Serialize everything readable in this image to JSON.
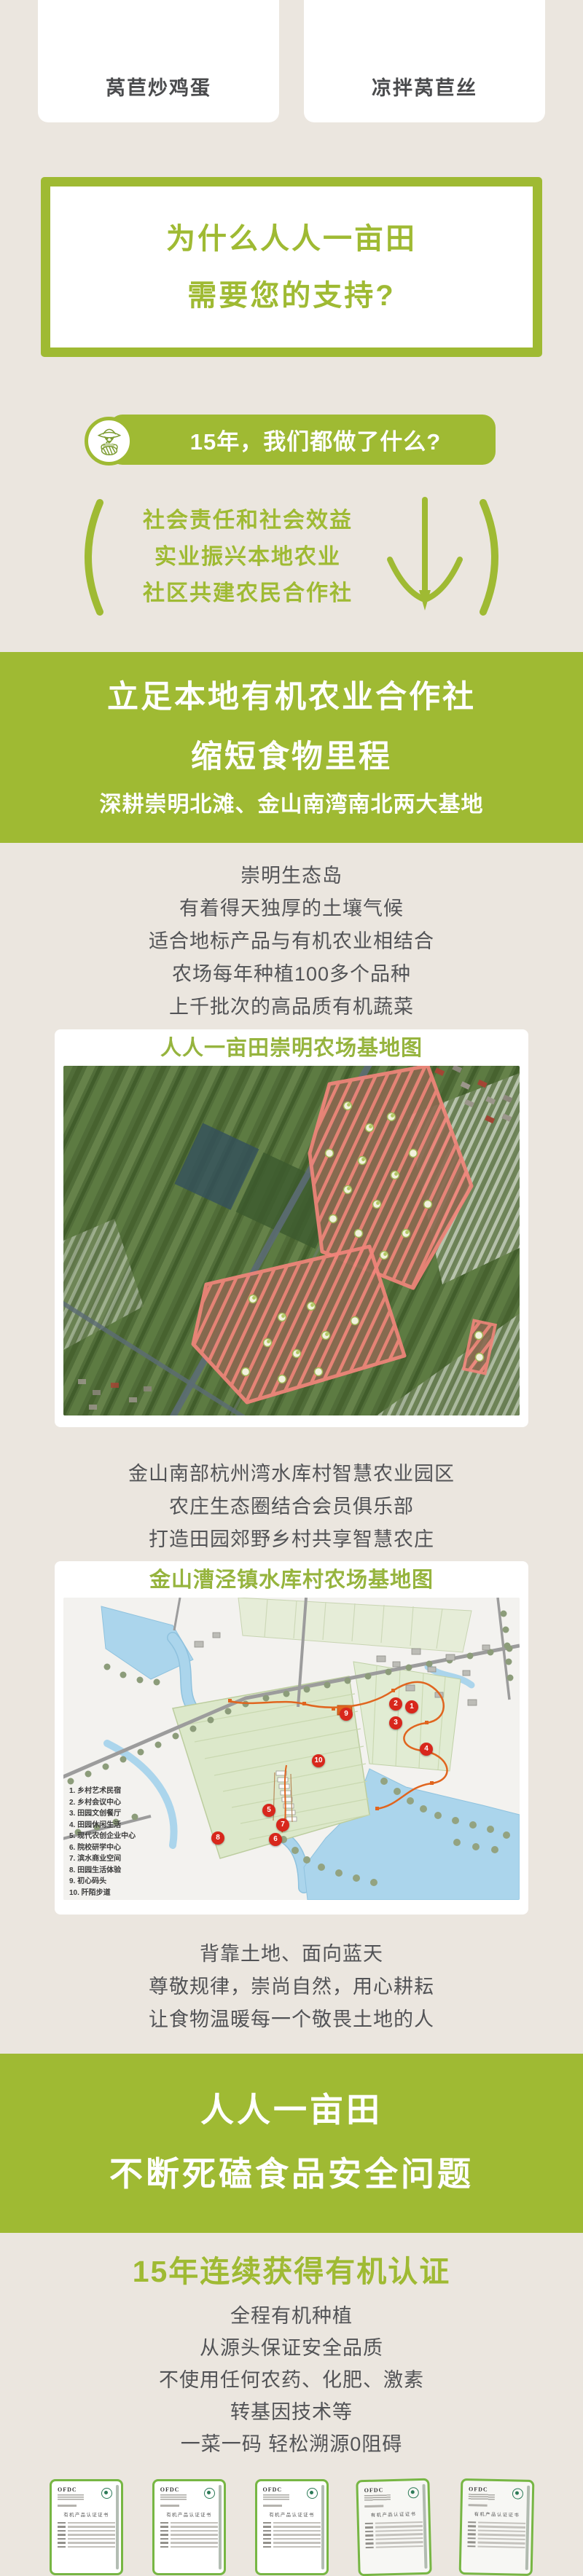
{
  "theme": {
    "green": "#9fba33",
    "beige": "#ebe6df",
    "text_gray": "#525356",
    "map_title_green": "#96b43e",
    "marker_red": "#d8271c",
    "plot_pink": "#f2857b",
    "water_blue": "#abd5ec",
    "route_orange": "#e0651f",
    "cert_border_green": "#77b644"
  },
  "dish_cards": [
    {
      "label": "莴苣炒鸡蛋"
    },
    {
      "label": "凉拌莴苣丝"
    }
  ],
  "support_box": {
    "line1": "为什么人人一亩田",
    "line2": "需要您的支持?"
  },
  "intro_banner": {
    "label": "15年，我们都做了什么?",
    "icon": "farmer-icon"
  },
  "pledge": {
    "lines": [
      "社会责任和社会效益",
      "实业振兴本地农业",
      "社区共建农民合作社"
    ]
  },
  "banner_coop": {
    "line1": "立足本地有机农业合作社",
    "line2": "缩短食物里程",
    "subtitle": "深耕崇明北滩、金山南湾南北两大基地"
  },
  "chongming": {
    "lines": [
      "崇明生态岛",
      "有着得天独厚的土壤气候",
      "适合地标产品与有机农业相结合",
      "农场每年种植100多个品种",
      "上千批次的高品质有机蔬菜"
    ]
  },
  "chongming_map": {
    "title": "人人一亩田崇明农场基地图"
  },
  "jinshan": {
    "lines": [
      "金山南部杭州湾水库村智慧农业园区",
      "农庄生态圈结合会员俱乐部",
      "打造田园郊野乡村共享智慧农庄"
    ]
  },
  "jinshan_map": {
    "title": "金山漕泾镇水库村农场基地图",
    "legend": [
      "1.  乡村艺术民宿",
      "2.  乡村会议中心",
      "3.  田园文创餐厅",
      "4.  田园休闲生活",
      "5.  现代农创企业中心",
      "6.  院校研学中心",
      "7.  滨水商业空间",
      "8.  田园生活体验",
      "9.  初心码头",
      "10. 阡陌步道"
    ],
    "markers": [
      "1",
      "2",
      "3",
      "4",
      "9",
      "10",
      "5",
      "7",
      "6",
      "8"
    ]
  },
  "motto": {
    "lines": [
      "背靠土地、面向蓝天",
      "尊敬规律，崇尚自然，用心耕耘",
      "让食物温暖每一个敬畏土地的人"
    ]
  },
  "banner_safety": {
    "line1": "人人一亩田",
    "line2": "不断死磕食品安全问题"
  },
  "organic": {
    "title": "15年连续获得有机认证",
    "lines": [
      "全程有机种植",
      "从源头保证安全品质",
      "不使用任何农药、化肥、激素",
      "转基因技术等",
      "一菜一码 轻松溯源0阻碍"
    ]
  },
  "certificates": {
    "logo": "OFDC",
    "title": "有机产品认证证书",
    "count": 5
  }
}
